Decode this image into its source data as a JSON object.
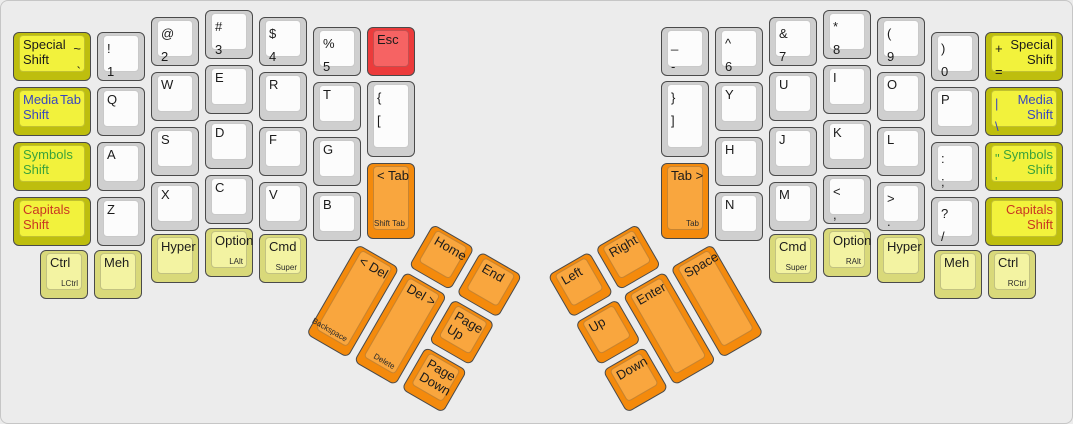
{
  "palette": {
    "white": {
      "side": "#cfcfcf",
      "top": "#fcfcfc"
    },
    "yellow": {
      "side": "#bebe0e",
      "top": "#f2f23c"
    },
    "pale": {
      "side": "#d9d97a",
      "top": "#f3f3a2"
    },
    "orange": {
      "side": "#f48a0c",
      "top": "#f9a63e"
    },
    "red": {
      "side": "#ec3b3b",
      "top": "#f66363"
    }
  },
  "ink": {
    "dark": "#1b1b1b",
    "blue": "#3947bf",
    "green": "#3ba23b",
    "red": "#c93722",
    "sub": "#2b2b2b"
  },
  "clusters": {
    "left": {
      "x": 357,
      "y": 243,
      "angle": 30
    },
    "right": {
      "x": 574,
      "y": 322,
      "angle": -30
    }
  },
  "keys": [
    {
      "id": "special-shift-left",
      "x": 12,
      "y": 31,
      "w": 78,
      "c": "yellow",
      "a": [
        "Special",
        "Shift"
      ],
      "b": [
        "~",
        "`"
      ]
    },
    {
      "id": "media-shift-left",
      "x": 12,
      "y": 86,
      "w": 78,
      "c": "yellow",
      "ink": "blue",
      "a": [
        "Media",
        "Shift"
      ],
      "b": [
        "Tab"
      ]
    },
    {
      "id": "symbols-shift-left",
      "x": 12,
      "y": 141,
      "w": 78,
      "c": "yellow",
      "ink": "green",
      "a": [
        "Symbols",
        "Shift"
      ]
    },
    {
      "id": "capitals-shift-left",
      "x": 12,
      "y": 196,
      "w": 78,
      "c": "yellow",
      "ink": "red",
      "a": [
        "Capitals",
        "Shift"
      ]
    },
    {
      "id": "num-1",
      "x": 96,
      "y": 31,
      "a": [
        "!",
        "1"
      ]
    },
    {
      "id": "letter-q",
      "x": 96,
      "y": 86,
      "a": [
        "Q"
      ]
    },
    {
      "id": "letter-a",
      "x": 96,
      "y": 141,
      "a": [
        "A"
      ]
    },
    {
      "id": "letter-z",
      "x": 96,
      "y": 196,
      "a": [
        "Z"
      ]
    },
    {
      "id": "num-2",
      "x": 150,
      "y": 16,
      "a": [
        "@",
        "2"
      ]
    },
    {
      "id": "letter-w",
      "x": 150,
      "y": 71,
      "a": [
        "W"
      ]
    },
    {
      "id": "letter-s",
      "x": 150,
      "y": 126,
      "a": [
        "S"
      ]
    },
    {
      "id": "letter-x",
      "x": 150,
      "y": 181,
      "a": [
        "X"
      ]
    },
    {
      "id": "num-3",
      "x": 204,
      "y": 9,
      "a": [
        "#",
        "3"
      ]
    },
    {
      "id": "letter-e",
      "x": 204,
      "y": 64,
      "a": [
        "E"
      ]
    },
    {
      "id": "letter-d",
      "x": 204,
      "y": 119,
      "a": [
        "D"
      ]
    },
    {
      "id": "letter-c",
      "x": 204,
      "y": 174,
      "a": [
        "C"
      ]
    },
    {
      "id": "num-4",
      "x": 258,
      "y": 16,
      "a": [
        "$",
        "4"
      ]
    },
    {
      "id": "letter-r",
      "x": 258,
      "y": 71,
      "a": [
        "R"
      ]
    },
    {
      "id": "letter-f",
      "x": 258,
      "y": 126,
      "a": [
        "F"
      ]
    },
    {
      "id": "letter-v",
      "x": 258,
      "y": 181,
      "a": [
        "V"
      ]
    },
    {
      "id": "num-5",
      "x": 312,
      "y": 26,
      "a": [
        "%",
        "5"
      ]
    },
    {
      "id": "letter-t",
      "x": 312,
      "y": 81,
      "a": [
        "T"
      ]
    },
    {
      "id": "letter-g",
      "x": 312,
      "y": 136,
      "a": [
        "G"
      ]
    },
    {
      "id": "letter-b",
      "x": 312,
      "y": 191,
      "a": [
        "B"
      ]
    },
    {
      "id": "esc",
      "x": 366,
      "y": 26,
      "c": "red",
      "a": [
        "Esc"
      ]
    },
    {
      "id": "bracket-open",
      "x": 366,
      "y": 80,
      "h": 76,
      "a": [
        "{",
        "["
      ]
    },
    {
      "id": "shift-tab",
      "x": 366,
      "y": 162,
      "h": 76,
      "c": "orange",
      "a": [
        "< Tab"
      ],
      "sub": "Shift Tab"
    },
    {
      "id": "ctrl-left",
      "x": 39,
      "y": 249,
      "c": "pale",
      "a": [
        "Ctrl"
      ],
      "sub": "LCtrl"
    },
    {
      "id": "meh-left",
      "x": 93,
      "y": 249,
      "c": "pale",
      "a": [
        "Meh"
      ]
    },
    {
      "id": "hyper-left",
      "x": 150,
      "y": 233,
      "c": "pale",
      "a": [
        "Hyper"
      ]
    },
    {
      "id": "option-left",
      "x": 204,
      "y": 227,
      "c": "pale",
      "a": [
        "Option"
      ],
      "sub": "LAlt"
    },
    {
      "id": "cmd-left",
      "x": 258,
      "y": 233,
      "c": "pale",
      "a": [
        "Cmd"
      ],
      "sub": "Super"
    },
    {
      "id": "backspace",
      "cl": "left",
      "x": 0,
      "y": 0,
      "h": 104,
      "c": "orange",
      "a": [
        "< Del"
      ],
      "sub": "Backspace"
    },
    {
      "id": "delete",
      "cl": "left",
      "x": 55,
      "y": 0,
      "h": 104,
      "c": "orange",
      "a": [
        "Del >"
      ],
      "sub": "Delete"
    },
    {
      "id": "home",
      "cl": "left",
      "x": 55,
      "y": -55,
      "c": "orange",
      "a": [
        "Home"
      ]
    },
    {
      "id": "end",
      "cl": "left",
      "x": 110,
      "y": -55,
      "c": "orange",
      "a": [
        "End"
      ]
    },
    {
      "id": "page-up",
      "cl": "left",
      "x": 110,
      "y": 0,
      "c": "orange",
      "a": [
        "Page",
        "Up"
      ]
    },
    {
      "id": "page-down",
      "cl": "left",
      "x": 110,
      "y": 55,
      "c": "orange",
      "a": [
        "Page",
        "Down"
      ]
    },
    {
      "id": "minus",
      "x": 660,
      "y": 26,
      "a": [
        "_",
        "-"
      ]
    },
    {
      "id": "bracket-close",
      "x": 660,
      "y": 80,
      "h": 76,
      "a": [
        "}",
        "]"
      ]
    },
    {
      "id": "tab",
      "x": 660,
      "y": 162,
      "h": 76,
      "c": "orange",
      "a": [
        "Tab >"
      ],
      "sub": "Tab"
    },
    {
      "id": "num-6",
      "x": 714,
      "y": 26,
      "a": [
        "^",
        "6"
      ]
    },
    {
      "id": "letter-y",
      "x": 714,
      "y": 81,
      "a": [
        "Y"
      ]
    },
    {
      "id": "letter-h",
      "x": 714,
      "y": 136,
      "a": [
        "H"
      ]
    },
    {
      "id": "letter-n",
      "x": 714,
      "y": 191,
      "a": [
        "N"
      ]
    },
    {
      "id": "num-7",
      "x": 768,
      "y": 16,
      "a": [
        "&",
        "7"
      ]
    },
    {
      "id": "letter-u",
      "x": 768,
      "y": 71,
      "a": [
        "U"
      ]
    },
    {
      "id": "letter-j",
      "x": 768,
      "y": 126,
      "a": [
        "J"
      ]
    },
    {
      "id": "letter-m",
      "x": 768,
      "y": 181,
      "a": [
        "M"
      ]
    },
    {
      "id": "num-8",
      "x": 822,
      "y": 9,
      "a": [
        "*",
        "8"
      ]
    },
    {
      "id": "letter-i",
      "x": 822,
      "y": 64,
      "a": [
        "I"
      ]
    },
    {
      "id": "letter-k",
      "x": 822,
      "y": 119,
      "a": [
        "K"
      ]
    },
    {
      "id": "comma",
      "x": 822,
      "y": 174,
      "a": [
        "<",
        ","
      ]
    },
    {
      "id": "num-9",
      "x": 876,
      "y": 16,
      "a": [
        "(",
        "9"
      ]
    },
    {
      "id": "letter-o",
      "x": 876,
      "y": 71,
      "a": [
        "O"
      ]
    },
    {
      "id": "letter-l",
      "x": 876,
      "y": 126,
      "a": [
        "L"
      ]
    },
    {
      "id": "period",
      "x": 876,
      "y": 181,
      "a": [
        ">",
        "."
      ]
    },
    {
      "id": "num-0",
      "x": 930,
      "y": 31,
      "a": [
        ")",
        "0"
      ]
    },
    {
      "id": "letter-p",
      "x": 930,
      "y": 86,
      "a": [
        "P"
      ]
    },
    {
      "id": "semicolon",
      "x": 930,
      "y": 141,
      "a": [
        ":",
        ";"
      ]
    },
    {
      "id": "slash",
      "x": 930,
      "y": 196,
      "a": [
        "?",
        "/"
      ]
    },
    {
      "id": "special-shift-right",
      "x": 984,
      "y": 31,
      "w": 78,
      "c": "yellow",
      "a": [
        "+",
        "="
      ],
      "b": [
        "Special",
        "Shift"
      ]
    },
    {
      "id": "media-shift-right",
      "x": 984,
      "y": 86,
      "w": 78,
      "c": "yellow",
      "ink": "blue",
      "a": [
        "|",
        "\\"
      ],
      "b": [
        "Media",
        "Shift"
      ]
    },
    {
      "id": "symbols-shift-right",
      "x": 984,
      "y": 141,
      "w": 78,
      "c": "yellow",
      "ink": "green",
      "a": [
        "\"",
        "'"
      ],
      "b": [
        "Symbols",
        "Shift"
      ]
    },
    {
      "id": "capitals-shift-right",
      "x": 984,
      "y": 196,
      "w": 78,
      "c": "yellow",
      "ink": "red",
      "b": [
        "Capitals",
        "Shift"
      ]
    },
    {
      "id": "cmd-right",
      "x": 768,
      "y": 233,
      "c": "pale",
      "a": [
        "Cmd"
      ],
      "sub": "Super"
    },
    {
      "id": "option-right",
      "x": 822,
      "y": 227,
      "c": "pale",
      "a": [
        "Option"
      ],
      "sub": "RAlt"
    },
    {
      "id": "hyper-right",
      "x": 876,
      "y": 233,
      "c": "pale",
      "a": [
        "Hyper"
      ]
    },
    {
      "id": "meh-right",
      "x": 933,
      "y": 249,
      "c": "pale",
      "a": [
        "Meh"
      ]
    },
    {
      "id": "ctrl-right",
      "x": 987,
      "y": 249,
      "c": "pale",
      "a": [
        "Ctrl"
      ],
      "sub": "RCtrl"
    },
    {
      "id": "up",
      "cl": "right",
      "x": 0,
      "y": 0,
      "c": "orange",
      "a": [
        "Up"
      ]
    },
    {
      "id": "left",
      "cl": "right",
      "x": 0,
      "y": -55,
      "c": "orange",
      "a": [
        "Left"
      ]
    },
    {
      "id": "right",
      "cl": "right",
      "x": 55,
      "y": -55,
      "c": "orange",
      "a": [
        "Right"
      ]
    },
    {
      "id": "enter",
      "cl": "right",
      "x": 55,
      "y": 0,
      "h": 104,
      "c": "orange",
      "a": [
        "Enter"
      ]
    },
    {
      "id": "down",
      "cl": "right",
      "x": 0,
      "y": 55,
      "c": "orange",
      "a": [
        "Down"
      ]
    },
    {
      "id": "space",
      "cl": "right",
      "x": 110,
      "y": 0,
      "h": 104,
      "c": "orange",
      "a": [
        "Space"
      ]
    }
  ]
}
